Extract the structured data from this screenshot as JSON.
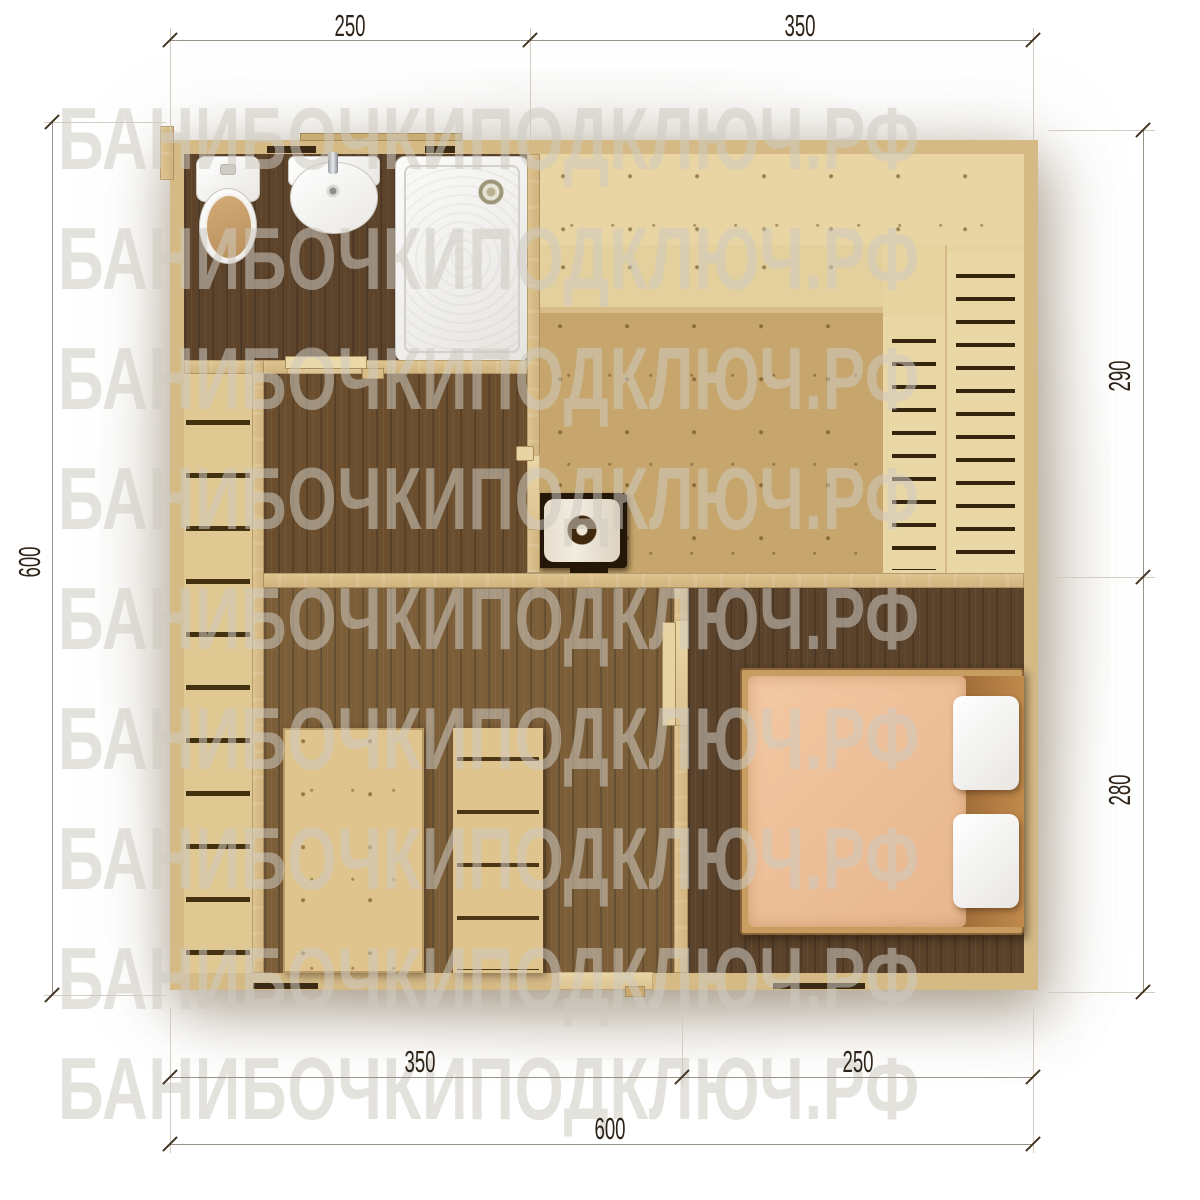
{
  "watermark": {
    "text": "БАНИБОЧКИПОДКЛЮЧ.РФ"
  },
  "dimensions": {
    "top": [
      {
        "label": "250"
      },
      {
        "label": "350"
      }
    ],
    "right": [
      {
        "label": "290"
      },
      {
        "label": "280"
      }
    ],
    "left": [
      {
        "label": "600"
      }
    ],
    "bottom_inner": [
      {
        "label": "350"
      },
      {
        "label": "250"
      }
    ],
    "bottom_outer": [
      {
        "label": "600"
      }
    ]
  },
  "colors": {
    "wall": "#d5ba86",
    "floor_dark": "#5c432a",
    "floor_medium": "#7c5e38",
    "bench_light": "#e8d5a3",
    "platform": "#c6a66c",
    "mattress": "#efc29c",
    "pillow": "#f4f3f1",
    "watermark": "#cdcac1",
    "dimension_text": "#2e2318"
  }
}
